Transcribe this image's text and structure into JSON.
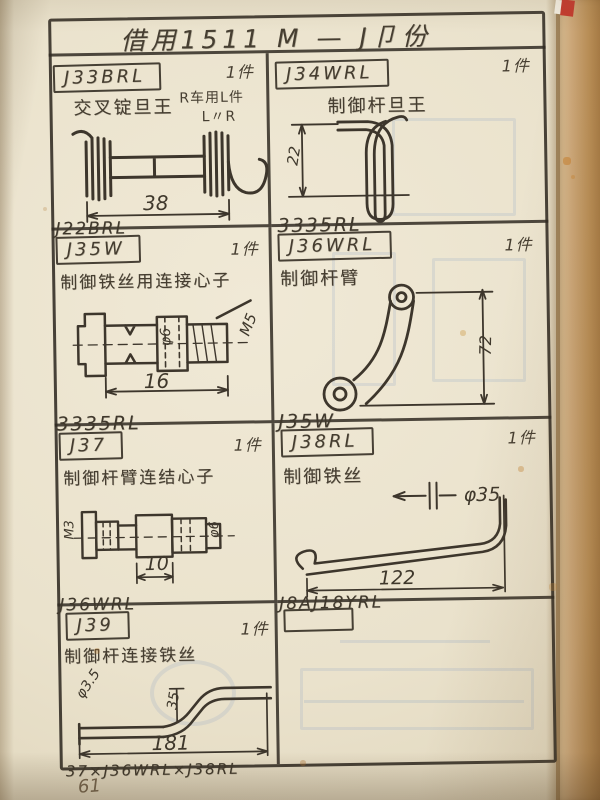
{
  "page": {
    "title": "借用1511 M — J卩份",
    "page_number": "61"
  },
  "cells": [
    {
      "part_id": "J33BRL",
      "qty": "1件",
      "desc": "交叉锭旦王",
      "note1": "R车用L件",
      "note2": "L〃R",
      "footer": "J22BRL",
      "dim_length": "38"
    },
    {
      "part_id": "J34WRL",
      "qty": "1件",
      "desc": "制御杆旦王",
      "footer": "3335RL",
      "dim_height": "22"
    },
    {
      "part_id": "J35W",
      "qty": "1件",
      "desc": "制御铁丝用连接心子",
      "footer": "3335RL",
      "dim_length": "16",
      "dim_dia": "φ6",
      "dim_thread": "M5"
    },
    {
      "part_id": "J36WRL",
      "qty": "1件",
      "desc": "制御杆臂",
      "footer": "J35W",
      "dim_length": "72"
    },
    {
      "part_id": "J37",
      "qty": "1件",
      "desc": "制御杆臂连结心子",
      "footer": "J36WRL",
      "dim_length": "10",
      "dim_thread": "M3",
      "dim_dia": "φ6"
    },
    {
      "part_id": "J38RL",
      "qty": "1件",
      "desc": "制御铁丝",
      "footer": "J8AJ18YRL",
      "dim_length": "122",
      "dim_dia": "φ35"
    },
    {
      "part_id": "J39",
      "qty": "1件",
      "desc": "制御杆连接铁丝",
      "footer": "37×J36WRL×J38RL",
      "dim_length": "181",
      "dim_dia": "φ3.5",
      "dim_height": "35"
    },
    {
      "part_id": "",
      "qty": "",
      "desc": "",
      "footer": ""
    }
  ]
}
